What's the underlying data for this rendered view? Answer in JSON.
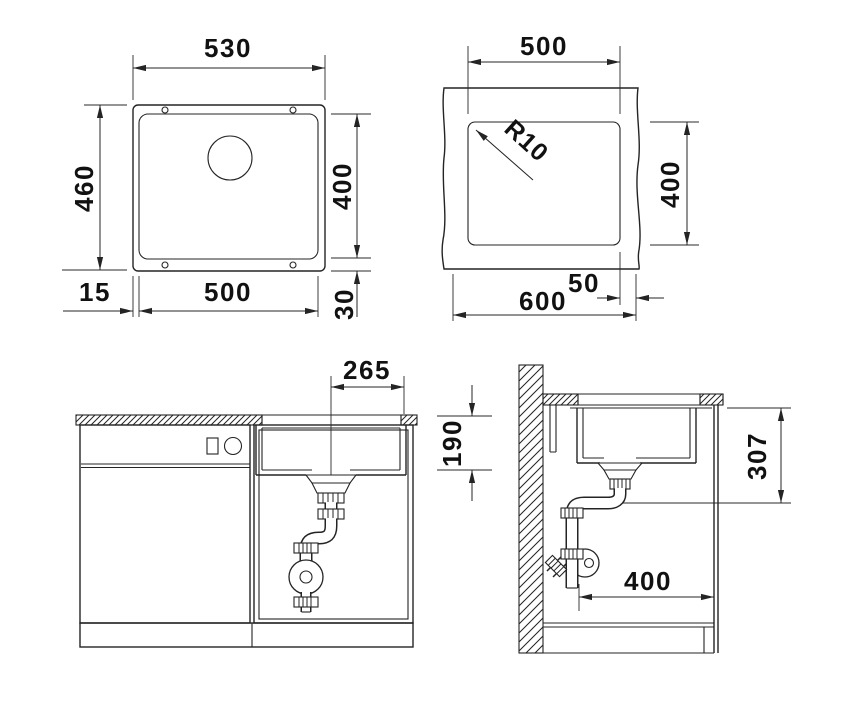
{
  "canvas": {
    "background": "#ffffff",
    "line_color": "#242424",
    "text_color": "#111111"
  },
  "views": {
    "plan": {
      "dims": {
        "outer_width": "530",
        "outer_height": "460",
        "inner_height": "400",
        "inner_width": "500",
        "flange_left": "15",
        "flange_bottom": "30"
      }
    },
    "cutout": {
      "dims": {
        "width": "500",
        "corner_radius": "R10",
        "height": "400",
        "worktop_width": "600",
        "edge_margin": "50"
      }
    },
    "front": {
      "dims": {
        "drain_to_edge": "265",
        "bowl_depth": "190"
      }
    },
    "side": {
      "dims": {
        "outlet_height": "307",
        "clearance": "400"
      }
    }
  }
}
